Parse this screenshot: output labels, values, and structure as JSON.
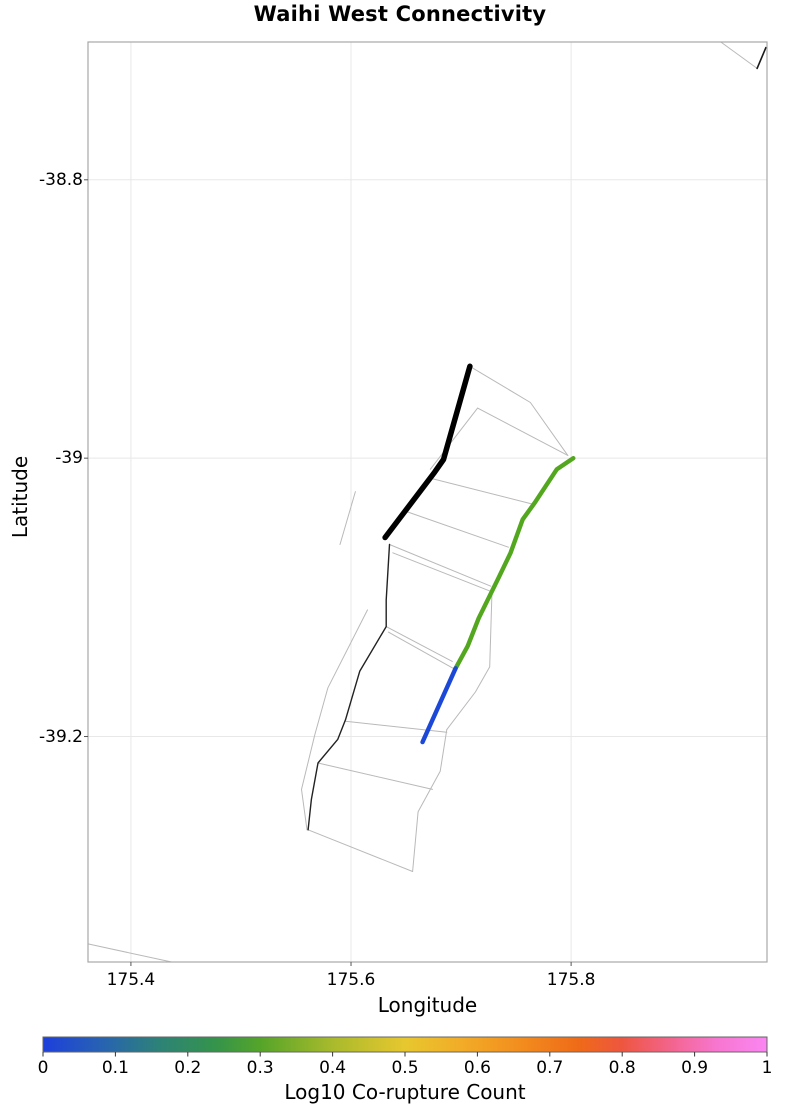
{
  "title": "Waihi West Connectivity",
  "chart_data": {
    "type": "line",
    "title": "Waihi West Connectivity",
    "xlabel": "Longitude",
    "ylabel": "Latitude",
    "xlim": [
      175.361,
      175.978
    ],
    "ylim": [
      -39.362,
      -38.701
    ],
    "xticks": [
      175.4,
      175.6,
      175.8
    ],
    "xtick_labels": [
      "175.4",
      "175.6",
      "175.8"
    ],
    "yticks": [
      -38.8,
      -39.0,
      -39.2
    ],
    "ytick_labels": [
      "-38.8",
      "-39",
      "-39.2"
    ],
    "grid": true,
    "grid_color": "#e8e8e8",
    "border_color": "#a8a8a8",
    "background": "#ffffff",
    "series": [
      {
        "name": "fault-section-outlines",
        "role": "background-mesh",
        "color": "#b9b9b9",
        "width": 1,
        "polylines": [
          [
            [
              175.71,
              -38.935
            ],
            [
              175.763,
              -38.96
            ],
            [
              175.797,
              -38.998
            ]
          ],
          [
            [
              175.715,
              -38.964
            ],
            [
              175.797,
              -38.998
            ]
          ],
          [
            [
              175.715,
              -38.964
            ],
            [
              175.672,
              -39.008
            ]
          ],
          [
            [
              175.67,
              -39.014
            ],
            [
              175.765,
              -39.033
            ]
          ],
          [
            [
              175.649,
              -39.038
            ],
            [
              175.743,
              -39.064
            ]
          ],
          [
            [
              175.635,
              -39.062
            ],
            [
              175.727,
              -39.092
            ]
          ],
          [
            [
              175.638,
              -39.068
            ],
            [
              175.728,
              -39.096
            ]
          ],
          [
            [
              175.632,
              -39.121
            ],
            [
              175.692,
              -39.146
            ]
          ],
          [
            [
              175.634,
              -39.125
            ],
            [
              175.695,
              -39.152
            ]
          ],
          [
            [
              175.595,
              -39.189
            ],
            [
              175.687,
              -39.197
            ]
          ],
          [
            [
              175.57,
              -39.219
            ],
            [
              175.674,
              -39.238
            ]
          ],
          [
            [
              175.687,
              -39.195
            ],
            [
              175.681,
              -39.225
            ],
            [
              175.661,
              -39.254
            ],
            [
              175.656,
              -39.297
            ]
          ],
          [
            [
              175.561,
              -39.267
            ],
            [
              175.656,
              -39.297
            ]
          ],
          [
            [
              175.615,
              -39.109
            ],
            [
              175.579,
              -39.165
            ],
            [
              175.567,
              -39.199
            ],
            [
              175.555,
              -39.238
            ],
            [
              175.56,
              -39.267
            ]
          ],
          [
            [
              175.604,
              -39.024
            ],
            [
              175.59,
              -39.062
            ]
          ],
          [
            [
              175.728,
              -39.098
            ],
            [
              175.726,
              -39.15
            ],
            [
              175.713,
              -39.168
            ],
            [
              175.687,
              -39.195
            ]
          ],
          [
            [
              175.936,
              -38.701
            ],
            [
              175.969,
              -38.72
            ]
          ],
          [
            [
              175.361,
              -39.349
            ],
            [
              175.437,
              -39.362
            ]
          ]
        ]
      },
      {
        "name": "corner-fault-trace",
        "role": "trace",
        "color": "#1a1a1a",
        "width": 1.6,
        "polylines": [
          [
            [
              175.969,
              -38.72
            ],
            [
              175.977,
              -38.705
            ]
          ]
        ]
      },
      {
        "name": "south-fault-trace-thin-black",
        "role": "trace",
        "color": "#222222",
        "width": 1.4,
        "polylines": [
          [
            [
              175.635,
              -39.062
            ],
            [
              175.632,
              -39.102
            ],
            [
              175.632,
              -39.121
            ],
            [
              175.608,
              -39.153
            ],
            [
              175.595,
              -39.188
            ],
            [
              175.588,
              -39.202
            ],
            [
              175.57,
              -39.219
            ],
            [
              175.564,
              -39.245
            ],
            [
              175.561,
              -39.267
            ]
          ]
        ]
      },
      {
        "name": "waihi-west-fault-trace-thick-black",
        "role": "trace",
        "color": "#000000",
        "width": 5.5,
        "polylines": [
          [
            [
              175.708,
              -38.934
            ],
            [
              175.684,
              -39.001
            ],
            [
              175.676,
              -39.01
            ],
            [
              175.631,
              -39.057
            ]
          ]
        ]
      },
      {
        "name": "co-rupture-trace-green",
        "role": "trace",
        "color": "#53a71e",
        "width": 4.4,
        "polylines": [
          [
            [
              175.802,
              -39.0
            ],
            [
              175.787,
              -39.008
            ],
            [
              175.767,
              -39.032
            ],
            [
              175.756,
              -39.044
            ],
            [
              175.745,
              -39.068
            ],
            [
              175.734,
              -39.086
            ],
            [
              175.716,
              -39.115
            ],
            [
              175.706,
              -39.135
            ],
            [
              175.695,
              -39.151
            ]
          ]
        ]
      },
      {
        "name": "co-rupture-trace-blue",
        "role": "trace",
        "color": "#1c48d8",
        "width": 4.4,
        "polylines": [
          [
            [
              175.695,
              -39.151
            ],
            [
              175.665,
              -39.204
            ]
          ]
        ]
      }
    ],
    "colorbar": {
      "label": "Log10 Co-rupture Count",
      "min": 0,
      "max": 1,
      "ticks": [
        0,
        0.1,
        0.2,
        0.3,
        0.4,
        0.5,
        0.6,
        0.7,
        0.8,
        0.9,
        1
      ],
      "tick_labels": [
        "0",
        "0.1",
        "0.2",
        "0.3",
        "0.4",
        "0.5",
        "0.6",
        "0.7",
        "0.8",
        "0.9",
        "1"
      ],
      "border_color": "#666666",
      "gradient_stops": [
        {
          "pos": 0.0,
          "color": "#1d3fdb"
        },
        {
          "pos": 0.08,
          "color": "#2762b3"
        },
        {
          "pos": 0.16,
          "color": "#2d8277"
        },
        {
          "pos": 0.24,
          "color": "#35944a"
        },
        {
          "pos": 0.3,
          "color": "#55a42a"
        },
        {
          "pos": 0.4,
          "color": "#a9ba2c"
        },
        {
          "pos": 0.5,
          "color": "#e7c72f"
        },
        {
          "pos": 0.58,
          "color": "#f2ab27"
        },
        {
          "pos": 0.66,
          "color": "#f28d1e"
        },
        {
          "pos": 0.74,
          "color": "#ef6a18"
        },
        {
          "pos": 0.8,
          "color": "#ee5640"
        },
        {
          "pos": 0.87,
          "color": "#f36590"
        },
        {
          "pos": 0.93,
          "color": "#f776cf"
        },
        {
          "pos": 1.0,
          "color": "#fa86f2"
        }
      ]
    }
  }
}
